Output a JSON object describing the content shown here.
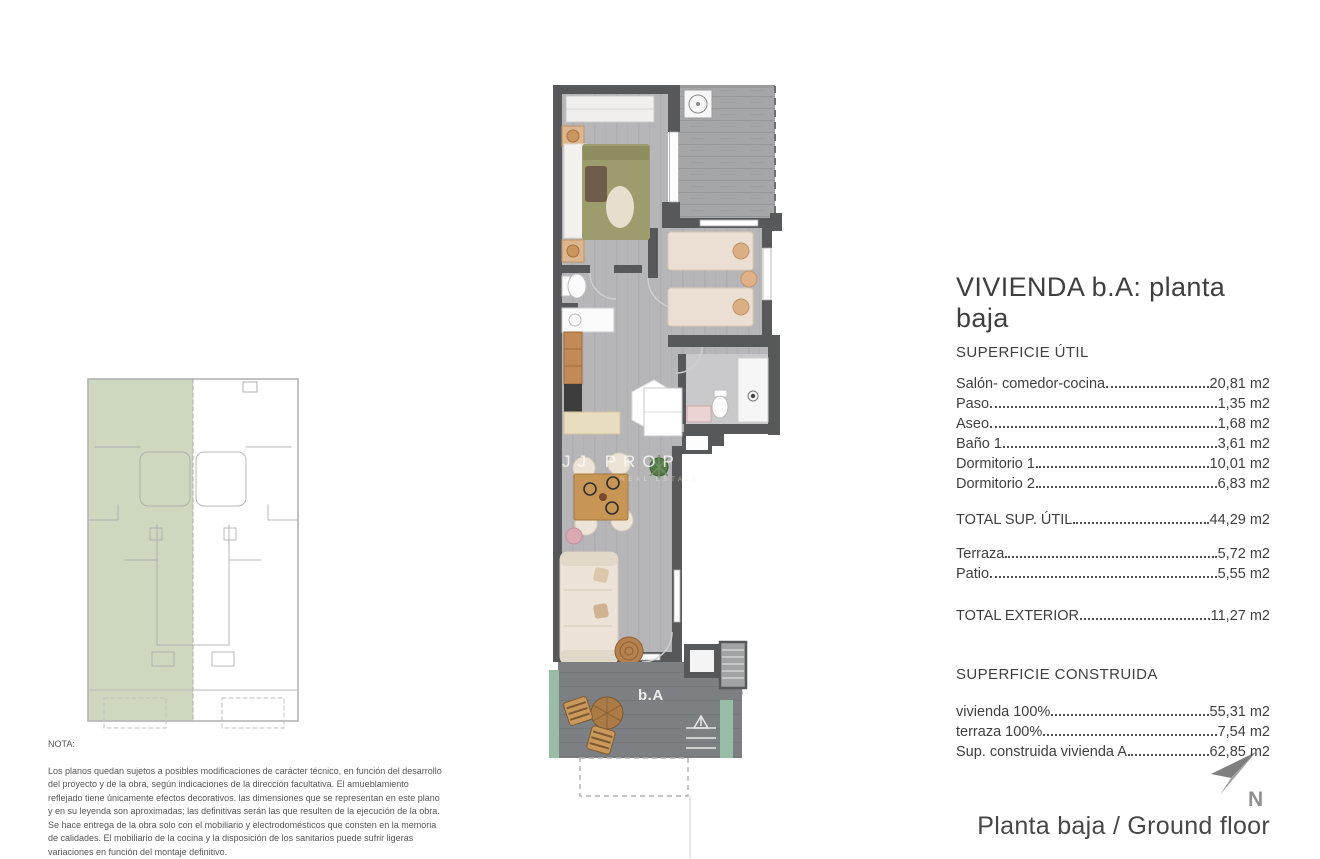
{
  "panel": {
    "title": "VIVIENDA b.A: planta baja",
    "section_util": {
      "heading": "SUPERFICIE ÚTIL",
      "items": [
        {
          "label": "Salón- comedor-cocina",
          "value": "20,81 m2"
        },
        {
          "label": "Paso",
          "value": "1,35 m2"
        },
        {
          "label": "Aseo",
          "value": "1,68 m2"
        },
        {
          "label": "Baño 1",
          "value": "3,61 m2"
        },
        {
          "label": "Dormitorio 1",
          "value": "10,01 m2"
        },
        {
          "label": "Dormitorio 2",
          "value": "6,83 m2"
        }
      ],
      "total": {
        "label": "TOTAL SUP. ÚTIL",
        "value": "44,29 m2"
      }
    },
    "section_exterior": {
      "items": [
        {
          "label": "Terraza",
          "value": "5,72 m2"
        },
        {
          "label": "Patio",
          "value": "5,55 m2"
        }
      ],
      "total": {
        "label": "TOTAL EXTERIOR",
        "value": "11,27 m2"
      }
    },
    "section_construida": {
      "heading": "SUPERFICIE CONSTRUIDA",
      "items": [
        {
          "label": "vivienda 100%",
          "value": "55,31 m2"
        },
        {
          "label": "terraza 100%",
          "value": "7,54 m2"
        },
        {
          "label": "Sup. construida vivienda A",
          "value": "62,85 m2"
        }
      ]
    }
  },
  "note": {
    "heading": "NOTA:",
    "body": "Los planos quedan sujetos a posibles modificaciones de carácter técnico, en función del desarrollo del proyecto y de la obra, según indicaciones de la dirección facultativa. El amueblamiento reflejado tiene únicamente efectos decorativos. las dimensiones que se representan en este plano y en su leyenda son aproximadas; las definitivas serán las que resulten de la ejecución de la obra. Se hace entrega de la obra solo con el mobiliario y electrodomésticos que consten en la memoria de calidades. El mobiliario de la cocina y la disposición de los sanitarios puede sufrir ligeras variaciones en función del montaje definitivo."
  },
  "plan": {
    "unit_label": "b.A",
    "watermark": "JJ PROPER",
    "watermark_sub": "REAL ESTATE"
  },
  "compass": {
    "north_label": "N"
  },
  "caption": "Planta baja / Ground floor",
  "colors": {
    "text": "#3f3f3f",
    "wall": "#57585a",
    "floor": "#b6b6b8",
    "patio_floor": "#a5a6a8",
    "terrace_floor": "#7d8082",
    "greenery": "#98bda6",
    "keyplan_highlight": "#cdd8bf",
    "keyplan_line": "#b4b4b4",
    "bed_olive": "#9c9c6d",
    "furniture_cream": "#ebe3d7",
    "wood": "#bb8350",
    "north_arrow": "#8d8d8d"
  }
}
